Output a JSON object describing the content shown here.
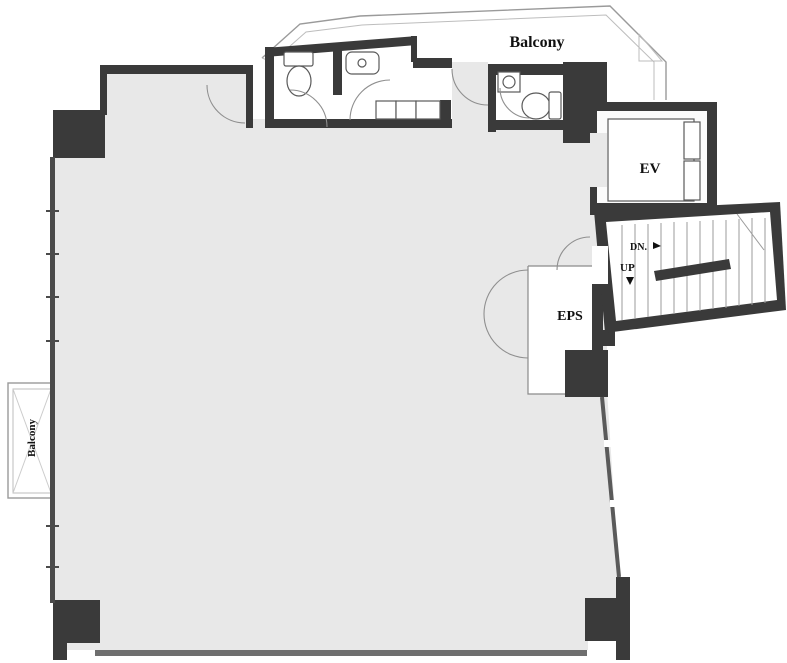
{
  "labels": {
    "balcony_top": "Balcony",
    "balcony_left": "Balcony",
    "elevator": "EV",
    "stairs_down": "DN.",
    "stairs_up": "UP",
    "eps": "EPS"
  },
  "colors": {
    "wall_dark": "#3a3a3a",
    "floor_gray": "#e8e8e8",
    "outline_gray": "#9a9a9a",
    "text": "#111111",
    "background": "#ffffff"
  }
}
